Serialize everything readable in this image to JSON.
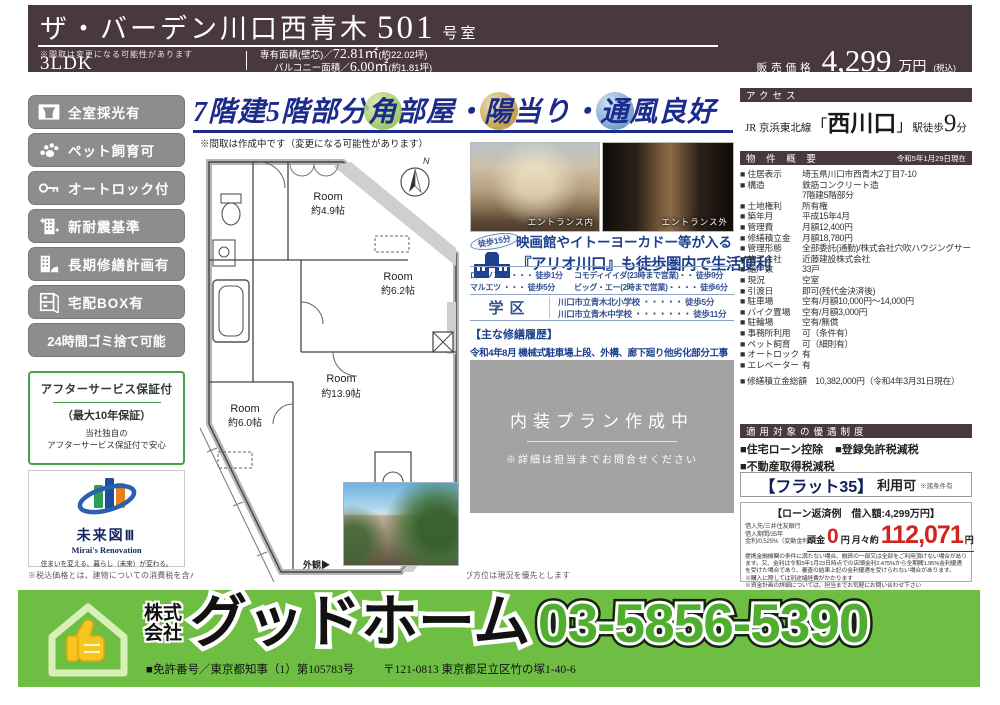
{
  "colors": {
    "band_brown": "#4a393c",
    "headline_navy": "#1c2c8c",
    "footer_green": "#6fbe44",
    "loan_red": "#d0241f",
    "badge_gray": "#8d8d8d",
    "guarantee_green": "#44a148"
  },
  "header": {
    "title": "ザ・バーデン川口西青木",
    "room_number": "501",
    "room_suffix": "号室",
    "note": "※間取は変更になる可能性があります",
    "layout": "3LDK",
    "area1_label": "専有面積(壁芯)／",
    "area1_value": "72.81㎡",
    "area1_paren": "(約22.02坪)",
    "area2_label": "バルコニー面積／",
    "area2_value": "6.00㎡",
    "area2_paren": "(約1.81坪)",
    "price_label": "販売価格",
    "price_value": "4,299",
    "price_unit": "万円",
    "price_tax": "(税込)"
  },
  "badges": [
    {
      "icon": "window-icon",
      "label": "全室採光有"
    },
    {
      "icon": "paw-icon",
      "label": "ペット飼育可"
    },
    {
      "icon": "key-icon",
      "label": "オートロック付"
    },
    {
      "icon": "quake-building-icon",
      "label": "新耐震基準"
    },
    {
      "icon": "repair-building-icon",
      "label": "長期修繕計画有"
    },
    {
      "icon": "delivery-box-icon",
      "label": "宅配BOX有"
    },
    {
      "icon": null,
      "label": "24時間ゴミ捨て可能"
    }
  ],
  "after_service": {
    "title": "アフターサービス保証付",
    "sub": "（最大10年保証）",
    "line1": "当社独自の",
    "line2": "アフターサービス保証付で安心"
  },
  "mirai": {
    "title": "未来図Ⅲ",
    "subtitle": "Mirai's Renovation",
    "tagline": "住まいを変える、暮らし（未来）が変わる。"
  },
  "disclaimer": "※税込価格とは、建物についての消費税を含んだ額です　※最終取引時の司法書士は当社指定と致します　※本図面および方位は現況を優先とします",
  "headline": {
    "pre": "7階建5階部分",
    "c1": "角",
    "m1": "部屋・",
    "c2": "陽",
    "m2": "当り・",
    "c3": "通",
    "post": "風良好",
    "note": "※間取は作成中です（変更になる可能性があります）"
  },
  "floorplan": {
    "rooms": [
      {
        "name": "Room",
        "size": "約4.9帖"
      },
      {
        "name": "Room",
        "size": "約6.2帖"
      },
      {
        "name": "Room",
        "size": "約13.9帖"
      },
      {
        "name": "Room",
        "size": "約6.0帖"
      }
    ],
    "compass": "N",
    "photo_label": "外観▶"
  },
  "photos": [
    {
      "caption": "エントランス内"
    },
    {
      "caption": "エントランス外"
    }
  ],
  "ario": {
    "walk_badge": "徒歩15分",
    "line1": "映画館やイトーヨーカドー等が入る",
    "line2": "『アリオ川口』も徒歩圏内で生活便利"
  },
  "stores": [
    "ローソン ・・・・ 徒歩1分",
    "マルエツ ・・・ 徒歩5分",
    "コモディイイダ(23時まで営業)・・ 徒歩9分",
    "ビッグ・エー(2時まで営業)・・・・ 徒歩6分"
  ],
  "school": {
    "label": "学区",
    "items": [
      "川口市立青木北小学校 ・・・・・ 徒歩5分",
      "川口市立青木中学校 ・・・・・・・ 徒歩11分"
    ]
  },
  "repair": {
    "title": "【主な修繕履歴】",
    "line": "令和4年8月  機械式駐車場上段、外構、廊下廻り他劣化部分工事"
  },
  "interior_box": {
    "title": "内装プラン作成中",
    "note": "※詳細は担当までお問合せください"
  },
  "access": {
    "header": "アクセス",
    "line_name": "JR 京浜東北線",
    "bracket_l": "「",
    "station": "西川口",
    "bracket_r": "」",
    "walk": "駅徒歩",
    "minutes": "9",
    "unit": "分"
  },
  "overview": {
    "header": "物 件 概 要",
    "asof": "令和5年1月29日現在",
    "rows": [
      {
        "label": "■ 住居表示",
        "value": "埼玉県川口市西青木2丁目7-10"
      },
      {
        "label": "■ 構造",
        "value": "鉄筋コンクリート造"
      },
      {
        "label": "",
        "value": "7階建5階部分"
      },
      {
        "label": "■ 土地権利",
        "value": "所有権"
      },
      {
        "label": "■ 築年月",
        "value": "平成15年4月"
      },
      {
        "label": "■ 管理費",
        "value": "月額12,400円"
      },
      {
        "label": "■ 修繕積立金",
        "value": "月額18,780円"
      },
      {
        "label": "■ 管理形態",
        "value": "全部委託(通勤)/株式会社穴吹ハウジングサービス"
      },
      {
        "label": "■ 施工会社",
        "value": "近藤建設株式会社"
      },
      {
        "label": "■ 総戸数",
        "value": "33戸"
      },
      {
        "label": "■ 現況",
        "value": "空室"
      },
      {
        "label": "■ 引渡日",
        "value": "即可(残代金決済後)"
      },
      {
        "label": "■ 駐車場",
        "value": "空有/月額10,000円～14,000円"
      },
      {
        "label": "■ バイク置場",
        "value": "空有/月額3,000円"
      },
      {
        "label": "■ 駐輪場",
        "value": "空有/無償"
      },
      {
        "label": "■ 事務所利用",
        "value": "可（条件有）"
      },
      {
        "label": "■ ペット飼育",
        "value": "可（細則有）"
      },
      {
        "label": "■ オートロック",
        "value": "有"
      },
      {
        "label": "■ エレベーター",
        "value": "有"
      }
    ],
    "total": "■ 修繕積立金総額　10,382,000円（令和4年3月31日現在）"
  },
  "privileges": {
    "header": "適用対象の優遇制度",
    "items": [
      "■住宅ローン控除",
      "■登録免許税減税",
      "■不動産取得税減税"
    ]
  },
  "flat35": {
    "main": "【フラット35】",
    "sub": "利用可",
    "note": "※諸条件有"
  },
  "loan": {
    "title": "【ローン返済例　借入額:4,299万円】",
    "details": [
      "借入先/三井住友銀行",
      "借入期間/35年",
      "金利/0.525%（変動金利）"
    ],
    "down_label": "頭金",
    "down_value": "0",
    "down_unit": "円",
    "monthly_label": "月々約",
    "monthly_value": "112,071",
    "monthly_unit": "円",
    "fine": "提携金融機関の条件に満たない場合、融資の一部又は全部をご利用頂けない場合があります。又、金利は令和5年1月23日時点での店頭金利2.475%から全期間1.95%金利優遇を受けた場合であり、審査の結果上記の金利優遇を受けられない場合があります。",
    "notes": [
      "※購入に際しては別途諸経費がかかります",
      "※資金計画の詳細については、担当までお気軽にお問い合わせ下さい"
    ]
  },
  "footer": {
    "company_stack1": "株式",
    "company_stack2": "会社",
    "company": "グッドホーム",
    "phone": "03-5856-5390",
    "license": "■免許番号／東京都知事（1）第105783号",
    "address": "〒121-0813 東京都足立区竹の塚1-40-6"
  }
}
